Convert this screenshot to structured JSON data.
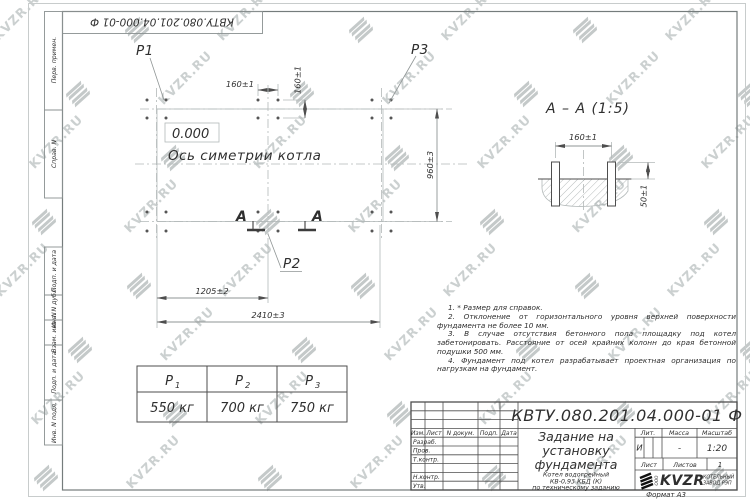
{
  "watermark": {
    "text": "KVZR.RU"
  },
  "frame": {
    "top_stamp": "КВТУ.080.201.04.000-01  Ф",
    "format_note": "Формат А3",
    "margin_labels": {
      "perv_primen": "Перв. примен.",
      "sprav_n": "Справ. N",
      "podp_data_1": "Подп. и дата",
      "inv_n_dubl": "Инв. N дубл.",
      "vzam_inv_n": "Взам. инв. N",
      "podp_data_2": "Подп. и дата",
      "inv_n_podl": "Инв. N подл."
    }
  },
  "plan": {
    "labels": {
      "p1": "P1",
      "p2": "P2",
      "p3": "P3",
      "elevation": "0.000",
      "axis": "Ось симетрии котла",
      "section_letter": "А"
    },
    "dims": {
      "bolt_span_h": "160±1",
      "bolt_span_v": "160±1",
      "width": "960±3",
      "half_length": "1205±2",
      "length": "2410±3"
    }
  },
  "section_view": {
    "title": "А – А (1:5)",
    "dims": {
      "bolt_span": "160±1",
      "protrusion": "50±1"
    }
  },
  "notes": [
    "1. * Размер для справок.",
    "2. Отклонение от горизонтального уровня верхней поверхности фундамента не более 10 мм.",
    "3. В случае отсутствия бетонного пола площадку под котел забетонировать. Расстояние от осей крайних колонн до края бетонной подушки 500 мм.",
    "4. Фундамент под котел разрабатывает проектная организация по нагрузкам на фундамент."
  ],
  "load_table": {
    "columns": [
      {
        "base": "P",
        "sub": "1",
        "value": "550 кг"
      },
      {
        "base": "P",
        "sub": "2",
        "value": "700 кг"
      },
      {
        "base": "P",
        "sub": "3",
        "value": "750 кг"
      }
    ]
  },
  "title_block": {
    "designation": "КВТУ.080.201.04.000-01  Ф",
    "document_title_lines": [
      "Задание на",
      "установку",
      "фундамента"
    ],
    "product_lines": [
      "Котел водогрейный",
      "КВ-0,93 КБД (К)",
      "по техническому заданию"
    ],
    "revision_header": {
      "izm": "Изм.",
      "list": "Лист",
      "n_dokum": "N докум.",
      "podp": "Подп.",
      "data": "Дата"
    },
    "signature_rows": {
      "razrab": "Разраб.",
      "prov": "Пров.",
      "t_kontr": "Т.контр.",
      "n_kontr": "Н.контр.",
      "utv": "Утв."
    },
    "props": {
      "lit_header": "Лит.",
      "mass_header": "Масса",
      "scale_header": "Масштаб",
      "lit": "И",
      "mass": "-",
      "scale": "1:20",
      "sheet_label": "Лист",
      "sheets_label": "Листов",
      "sheets_value": "1"
    },
    "logo": {
      "company_prefix": "ООО",
      "name": "KVZR",
      "caption_line1": "КОТЕЛЬНЫЙ",
      "caption_line2": "ЗАВОД РЭП"
    }
  }
}
